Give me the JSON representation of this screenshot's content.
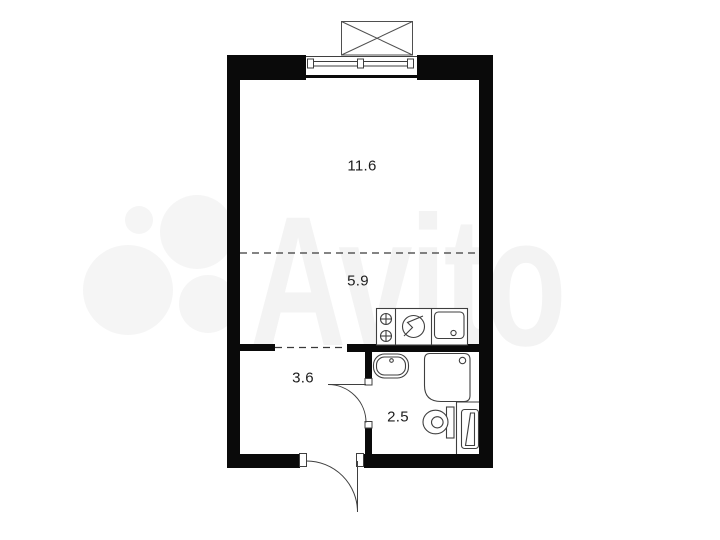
{
  "watermark": {
    "text": "Avito",
    "text_color": "#f3f3f3",
    "logo_circle_color": "#f5f5f5"
  },
  "floorplan": {
    "background_color": "#ffffff",
    "wall_color": "#0a0a0a",
    "line_color": "#3f3f3f",
    "rooms": [
      {
        "id": "living-room",
        "area_label": "11.6"
      },
      {
        "id": "kitchen-zone",
        "area_label": "5.9"
      },
      {
        "id": "hallway",
        "area_label": "3.6"
      },
      {
        "id": "bathroom",
        "area_label": "2.5"
      }
    ],
    "icons": [
      "window-icon",
      "balcony-box-icon",
      "stove-burners-icon",
      "electric-stove-icon",
      "kitchen-sink-icon",
      "washbasin-icon",
      "shower-icon",
      "toilet-icon",
      "water-heater-icon",
      "entrance-door-arc-icon",
      "bathroom-door-arc-icon"
    ]
  }
}
